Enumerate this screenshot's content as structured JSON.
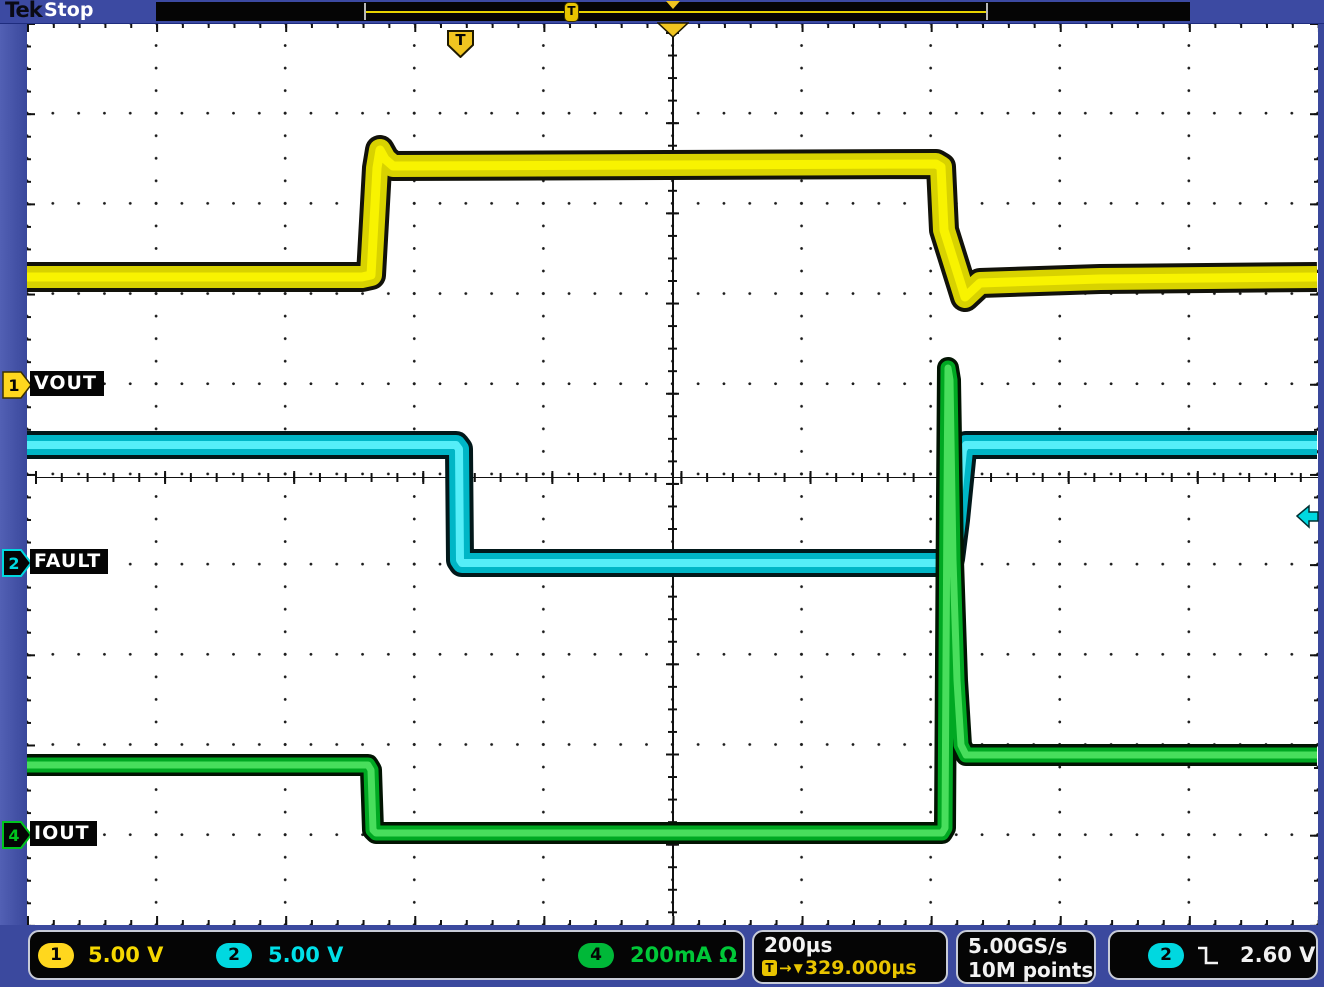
{
  "header": {
    "logo": "Tek",
    "status": "Stop",
    "trigger_marker": "T"
  },
  "channels": [
    {
      "id": "1",
      "label": "VOUT",
      "color": "#e8e000",
      "scale": "5.00 V"
    },
    {
      "id": "2",
      "label": "FAULT",
      "color": "#00d8e0",
      "scale": "5.00 V"
    },
    {
      "id": "4",
      "label": "IOUT",
      "color": "#00c41e",
      "scale": "200mA Ω"
    }
  ],
  "timebase": {
    "scale": "200µs",
    "t_icon": "T",
    "arrow": "→",
    "cursor": "▼",
    "delay": "329.000µs"
  },
  "acquisition": {
    "sample_rate": "5.00GS/s",
    "record_length": "10M points"
  },
  "trigger": {
    "source": "2",
    "level": "2.60 V",
    "slope": "falling"
  },
  "chart_data": {
    "type": "line",
    "title": "Oscilloscope capture: load-transient with fault flag",
    "x_units": "time, 200µs/div, 10 divisions",
    "y_units": "CH1 5.00 V/div, CH2 5.00 V/div, CH4 200mA/div",
    "grid": {
      "x_divisions": 10,
      "y_divisions": 10,
      "style": "dotted"
    },
    "series": [
      {
        "name": "VOUT",
        "channel": 1,
        "points_px": [
          [
            27,
            277
          ],
          [
            362,
            277
          ],
          [
            371,
            275
          ],
          [
            377,
            168
          ],
          [
            380,
            150
          ],
          [
            385,
            159
          ],
          [
            393,
            166
          ],
          [
            936,
            164
          ],
          [
            941,
            167
          ],
          [
            944,
            230
          ],
          [
            965,
            297
          ],
          [
            980,
            283
          ],
          [
            1100,
            279
          ],
          [
            1317,
            277
          ]
        ]
      },
      {
        "name": "FAULT",
        "channel": 2,
        "points_px": [
          [
            27,
            445
          ],
          [
            456,
            445
          ],
          [
            459,
            449
          ],
          [
            460,
            560
          ],
          [
            462,
            563
          ],
          [
            944,
            563
          ],
          [
            951,
            559
          ],
          [
            956,
            520
          ],
          [
            963,
            450
          ],
          [
            966,
            445
          ],
          [
            1317,
            445
          ]
        ]
      },
      {
        "name": "IOUT",
        "channel": 4,
        "points_px": [
          [
            27,
            765
          ],
          [
            368,
            765
          ],
          [
            371,
            770
          ],
          [
            373,
            830
          ],
          [
            376,
            833
          ],
          [
            942,
            833
          ],
          [
            945,
            828
          ],
          [
            947,
            500
          ],
          [
            948,
            368
          ],
          [
            950,
            380
          ],
          [
            953,
            560
          ],
          [
            957,
            680
          ],
          [
            961,
            745
          ],
          [
            966,
            755
          ],
          [
            1317,
            755
          ]
        ]
      }
    ]
  }
}
